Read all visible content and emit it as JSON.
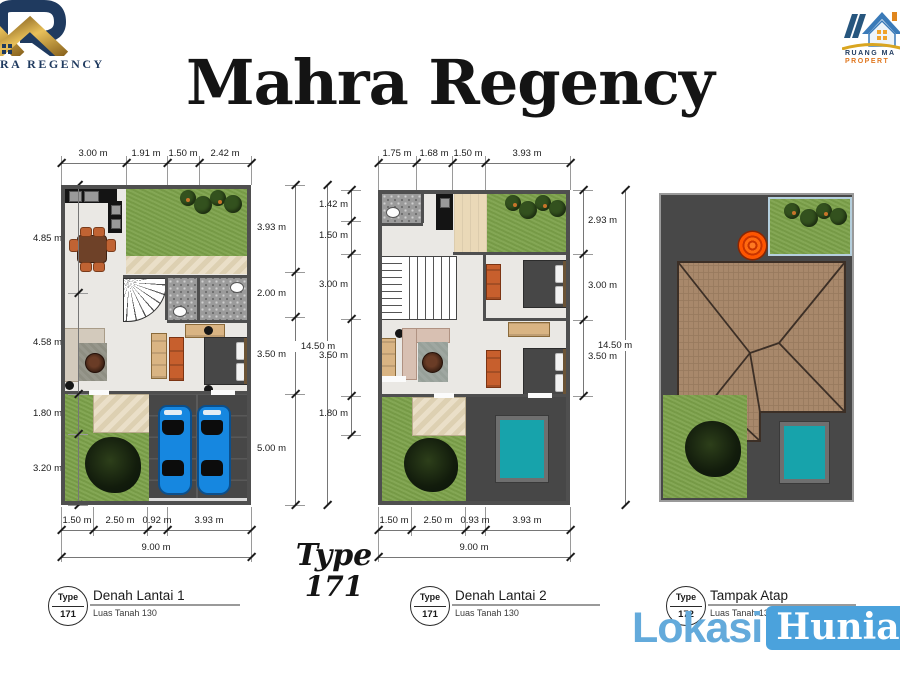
{
  "slide": {
    "title": "Mahra Regency"
  },
  "left_logo": {
    "caption": "RA REGENCY"
  },
  "right_logo": {
    "line1": "RUANG MA",
    "line2": "PROPERT"
  },
  "type_display": {
    "line1": "Type",
    "line2": "171"
  },
  "watermark": {
    "part1": "Lokasi",
    "part2": "Hunian"
  },
  "plans": [
    {
      "title": "Denah Lantai 1",
      "subtitle": "Luas Tanah 130",
      "badge_top": "Type",
      "badge_num": "171",
      "dims_top": [
        "3.00 m",
        "1.91 m",
        "1.50 m",
        "2.42 m"
      ],
      "dims_bottom": [
        "1.50 m",
        "2.50 m",
        "0.92 m",
        "3.93 m"
      ],
      "total_bottom": "9.00 m",
      "dims_left": [
        "4.85 m",
        "4.58 m",
        "1.80 m",
        "3.20 m"
      ],
      "dims_right": [
        "3.93 m",
        "2.00 m",
        "3.50 m",
        "5.00 m"
      ],
      "total_right": "14.50 m"
    },
    {
      "title": "Denah Lantai 2",
      "subtitle": "Luas Tanah 130",
      "badge_top": "Type",
      "badge_num": "171",
      "dims_top": [
        "1.75 m",
        "1.68 m",
        "1.50 m",
        "3.93 m"
      ],
      "dims_bottom": [
        "1.50 m",
        "2.50 m",
        "0.93 m",
        "3.93 m"
      ],
      "total_bottom": "9.00 m",
      "dims_left": [
        "1.42 m",
        "1.50 m",
        "3.00 m",
        "3.50 m",
        "1.80 m"
      ],
      "dims_right": [
        "2.93 m",
        "3.00 m",
        "3.50 m"
      ],
      "total_right": "14.50 m"
    },
    {
      "title": "Tampak Atap",
      "subtitle": "Luas Tanah 130",
      "badge_top": "Type",
      "badge_num": "172"
    }
  ],
  "colors": {
    "watermark_blue": "#4ba2dc",
    "watermark_light_blue": "#63aadb",
    "car_blue": "#1687e0",
    "pool_teal": "#17a3ab",
    "lawn_green": "#7ca24a",
    "roof_brown": "#a8886b",
    "wall_gray": "#4f4f4f",
    "logo_gold": "#c89a3c",
    "logo_navy": "#1f3a5f",
    "tank_orange": "#ff5500"
  }
}
